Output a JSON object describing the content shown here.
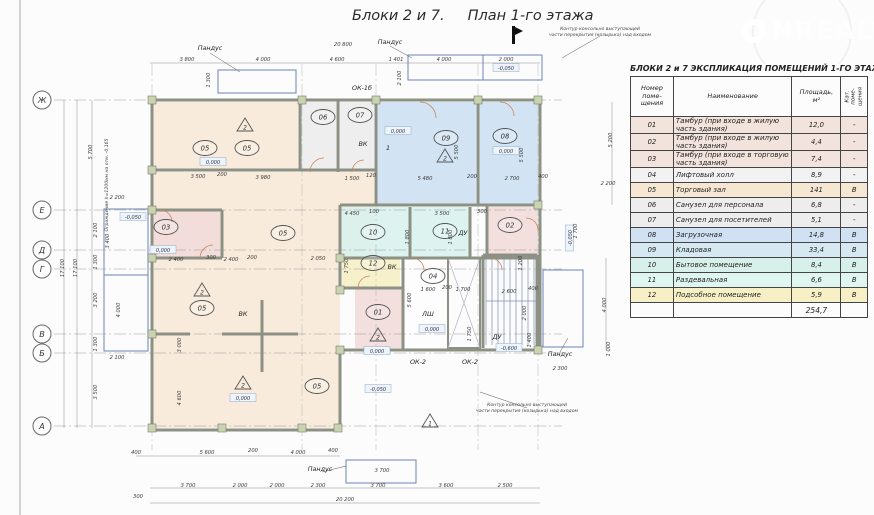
{
  "title": "Блоки 2 и 7.     План 1-го этажа",
  "watermark": {
    "full": "ONREALT",
    "text": "NREALT"
  },
  "table": {
    "title": "БЛОКИ  2 и 7   ЭКСПЛИКАЦИЯ ПОМЕЩЕНИЙ 1-ГО ЭТАЖА",
    "headers": {
      "num": "Номер\nпоме-\nщения",
      "name": "Наименование",
      "area": "Площадь,\nм²",
      "cat": "Кат. поме-\nщения"
    },
    "rows": [
      {
        "num": "01",
        "name": "Тамбур (при входе в жилую часть здания)",
        "area": "12,0",
        "cat": "-",
        "color": "#f2e3dd"
      },
      {
        "num": "02",
        "name": "Тамбур (при входе в жилую часть здания)",
        "area": "4,4",
        "cat": "-",
        "color": "#f2e3dd"
      },
      {
        "num": "03",
        "name": "Тамбур (при входе в торговую часть здания)",
        "area": "7,4",
        "cat": "-",
        "color": "#f2e3dd"
      },
      {
        "num": "04",
        "name": "Лифтовый холл",
        "area": "8,9",
        "cat": "-",
        "color": "#f2f2f2"
      },
      {
        "num": "05",
        "name": "Торговый зал",
        "area": "141",
        "cat": "В",
        "color": "#f6e7d3"
      },
      {
        "num": "06",
        "name": "Санузел  для персонала",
        "area": "6,8",
        "cat": "-",
        "color": "#ededed"
      },
      {
        "num": "07",
        "name": "Санузел  для посетителей",
        "area": "5,1",
        "cat": "-",
        "color": "#ededed"
      },
      {
        "num": "08",
        "name": "Загрузочная",
        "area": "14,8",
        "cat": "В",
        "color": "#cfe1f3"
      },
      {
        "num": "09",
        "name": "Кладовая",
        "area": "33,4",
        "cat": "В",
        "color": "#d6e9f2"
      },
      {
        "num": "10",
        "name": "Бытовое помещение",
        "area": "8,4",
        "cat": "В",
        "color": "#d7f1ea"
      },
      {
        "num": "11",
        "name": "Раздевальная",
        "area": "6,6",
        "cat": "В",
        "color": "#def5f0"
      },
      {
        "num": "12",
        "name": "Подсобное помещение",
        "area": "5,9",
        "cat": "В",
        "color": "#f7f0c6"
      }
    ],
    "total": "254,7"
  },
  "colors": {
    "tan": "#f7e9d8",
    "blue": "#cde0f2",
    "cyan": "#d9f2ed",
    "pink": "#f1dcda",
    "grey": "#ececec",
    "yellow": "#f6efc5",
    "white": "#fdfdfd",
    "wall": "#8d9184",
    "ramp": "#6b84b8",
    "dim": "#3a3a3a"
  },
  "plan": {
    "axes": [
      {
        "label": "Ж",
        "y": 100
      },
      {
        "label": "Е",
        "y": 210
      },
      {
        "label": "Д",
        "y": 250
      },
      {
        "label": "Г",
        "y": 269
      },
      {
        "label": "В",
        "y": 334
      },
      {
        "label": "Б",
        "y": 353
      },
      {
        "label": "А",
        "y": 426
      }
    ],
    "rooms": [
      {
        "id": "05a",
        "x": 152,
        "y": 102,
        "w": 146,
        "h": 68,
        "fill": "tan"
      },
      {
        "id": "06",
        "x": 300,
        "y": 102,
        "w": 36,
        "h": 70,
        "fill": "grey"
      },
      {
        "id": "07",
        "x": 338,
        "y": 102,
        "w": 36,
        "h": 70,
        "fill": "grey"
      },
      {
        "id": "09",
        "x": 376,
        "y": 102,
        "w": 100,
        "h": 102,
        "fill": "blue"
      },
      {
        "id": "08",
        "x": 478,
        "y": 102,
        "w": 60,
        "h": 102,
        "fill": "blue"
      },
      {
        "id": "05b",
        "x": 152,
        "y": 172,
        "w": 222,
        "h": 86,
        "fill": "tan"
      },
      {
        "id": "05c",
        "x": 152,
        "y": 258,
        "w": 188,
        "h": 170,
        "fill": "tan"
      },
      {
        "id": "03",
        "x": 152,
        "y": 210,
        "w": 68,
        "h": 48,
        "fill": "pink"
      },
      {
        "id": "10",
        "x": 342,
        "y": 207,
        "w": 68,
        "h": 51,
        "fill": "cyan"
      },
      {
        "id": "11",
        "x": 410,
        "y": 207,
        "w": 60,
        "h": 51,
        "fill": "cyan"
      },
      {
        "id": "02",
        "x": 487,
        "y": 207,
        "w": 51,
        "h": 51,
        "fill": "pink"
      },
      {
        "id": "12",
        "x": 342,
        "y": 258,
        "w": 58,
        "h": 30,
        "fill": "yellow"
      },
      {
        "id": "01",
        "x": 355,
        "y": 288,
        "w": 48,
        "h": 60,
        "fill": "pink"
      },
      {
        "id": "04",
        "x": 403,
        "y": 258,
        "w": 45,
        "h": 90,
        "fill": "white"
      }
    ],
    "tags": [
      {
        "t": "05",
        "x": 205,
        "y": 148
      },
      {
        "t": "05",
        "x": 247,
        "y": 148
      },
      {
        "t": "06",
        "x": 323,
        "y": 117
      },
      {
        "t": "07",
        "x": 360,
        "y": 115
      },
      {
        "t": "09",
        "x": 446,
        "y": 138
      },
      {
        "t": "08",
        "x": 505,
        "y": 136
      },
      {
        "t": "05",
        "x": 283,
        "y": 233
      },
      {
        "t": "03",
        "x": 166,
        "y": 227
      },
      {
        "t": "10",
        "x": 373,
        "y": 232
      },
      {
        "t": "11",
        "x": 445,
        "y": 231
      },
      {
        "t": "02",
        "x": 510,
        "y": 225
      },
      {
        "t": "12",
        "x": 373,
        "y": 263
      },
      {
        "t": "01",
        "x": 378,
        "y": 312
      },
      {
        "t": "04",
        "x": 433,
        "y": 276
      },
      {
        "t": "05",
        "x": 202,
        "y": 308
      },
      {
        "t": "05",
        "x": 317,
        "y": 386
      }
    ],
    "triangles": [
      {
        "t": "2",
        "x": 245,
        "y": 126
      },
      {
        "t": "2",
        "x": 445,
        "y": 157
      },
      {
        "t": "2",
        "x": 202,
        "y": 291
      },
      {
        "t": "2",
        "x": 243,
        "y": 384
      },
      {
        "t": "2",
        "x": 378,
        "y": 336
      },
      {
        "t": "1",
        "x": 430,
        "y": 422
      }
    ],
    "levels": [
      {
        "t": "0,000",
        "x": 213,
        "y": 163
      },
      {
        "t": "0,000",
        "x": 398,
        "y": 132
      },
      {
        "t": "0,000",
        "x": 506,
        "y": 152
      },
      {
        "t": "0,000",
        "x": 163,
        "y": 251
      },
      {
        "t": "0,000",
        "x": 243,
        "y": 399
      },
      {
        "t": "0,000",
        "x": 377,
        "y": 352
      },
      {
        "t": "0,000",
        "x": 432,
        "y": 330
      },
      {
        "t": "-0,050",
        "x": 133,
        "y": 218
      },
      {
        "t": "-0,050",
        "x": 506,
        "y": 69
      },
      {
        "t": "-0,050",
        "x": 571,
        "y": 238,
        "r": -90
      },
      {
        "t": "-0,050",
        "x": 378,
        "y": 390
      },
      {
        "t": "-0,600",
        "x": 509,
        "y": 349
      }
    ],
    "labels": [
      {
        "t": "Пандус",
        "x": 210,
        "y": 50
      },
      {
        "t": "Пандус",
        "x": 390,
        "y": 44
      },
      {
        "t": "Пандус",
        "x": 560,
        "y": 356
      },
      {
        "t": "Пандус",
        "x": 320,
        "y": 471
      },
      {
        "t": "ВК",
        "x": 363,
        "y": 146
      },
      {
        "t": "ВК",
        "x": 243,
        "y": 316
      },
      {
        "t": "ВК",
        "x": 392,
        "y": 269
      },
      {
        "t": "ЛШ",
        "x": 428,
        "y": 316
      },
      {
        "t": "ДУ",
        "x": 463,
        "y": 235
      },
      {
        "t": "ДУ",
        "x": 497,
        "y": 339
      },
      {
        "t": "1",
        "x": 388,
        "y": 150
      },
      {
        "t": "ОК-1б",
        "x": 362,
        "y": 90
      },
      {
        "t": "ОК-2",
        "x": 418,
        "y": 364
      },
      {
        "t": "ОК-2",
        "x": 470,
        "y": 364
      }
    ],
    "dims": [
      {
        "t": "20 800",
        "x": 343,
        "y": 46
      },
      {
        "t": "3 800",
        "x": 187,
        "y": 61
      },
      {
        "t": "4 000",
        "x": 263,
        "y": 61
      },
      {
        "t": "4 600",
        "x": 337,
        "y": 61
      },
      {
        "t": "1 401",
        "x": 396,
        "y": 61
      },
      {
        "t": "4 000",
        "x": 444,
        "y": 61
      },
      {
        "t": "2 000",
        "x": 506,
        "y": 61
      },
      {
        "t": "1 300",
        "x": 210,
        "y": 80,
        "r": -90
      },
      {
        "t": "2 100",
        "x": 401,
        "y": 78,
        "r": -90
      },
      {
        "t": "3 500",
        "x": 198,
        "y": 178
      },
      {
        "t": "200",
        "x": 222,
        "y": 176
      },
      {
        "t": "3 980",
        "x": 263,
        "y": 179
      },
      {
        "t": "1 500",
        "x": 352,
        "y": 180
      },
      {
        "t": "120",
        "x": 371,
        "y": 177
      },
      {
        "t": "5 480",
        "x": 425,
        "y": 180
      },
      {
        "t": "200",
        "x": 472,
        "y": 178
      },
      {
        "t": "2 700",
        "x": 512,
        "y": 180
      },
      {
        "t": "400",
        "x": 543,
        "y": 178
      },
      {
        "t": "2 200",
        "x": 608,
        "y": 185
      },
      {
        "t": "4 450",
        "x": 352,
        "y": 215
      },
      {
        "t": "100",
        "x": 374,
        "y": 213
      },
      {
        "t": "3 500",
        "x": 442,
        "y": 215
      },
      {
        "t": "300",
        "x": 482,
        "y": 213
      },
      {
        "t": "2 400",
        "x": 176,
        "y": 261
      },
      {
        "t": "300",
        "x": 211,
        "y": 259
      },
      {
        "t": "2 400",
        "x": 231,
        "y": 261
      },
      {
        "t": "200",
        "x": 252,
        "y": 259
      },
      {
        "t": "2 050",
        "x": 318,
        "y": 260
      },
      {
        "t": "1 750",
        "x": 348,
        "y": 266,
        "r": -90
      },
      {
        "t": "5 600",
        "x": 411,
        "y": 300,
        "r": -90
      },
      {
        "t": "1 600",
        "x": 428,
        "y": 291
      },
      {
        "t": "200",
        "x": 447,
        "y": 289
      },
      {
        "t": "1 700",
        "x": 463,
        "y": 291
      },
      {
        "t": "2 600",
        "x": 509,
        "y": 293
      },
      {
        "t": "400",
        "x": 533,
        "y": 290
      },
      {
        "t": "1 200",
        "x": 522,
        "y": 263,
        "r": -90
      },
      {
        "t": "2 000",
        "x": 526,
        "y": 313,
        "r": -90
      },
      {
        "t": "1 400",
        "x": 531,
        "y": 340,
        "r": -90
      },
      {
        "t": "1 750",
        "x": 471,
        "y": 334,
        "r": -90
      },
      {
        "t": "5 500",
        "x": 458,
        "y": 152,
        "r": -90
      },
      {
        "t": "5 500",
        "x": 523,
        "y": 155,
        "r": -90
      },
      {
        "t": "5 200",
        "x": 612,
        "y": 140,
        "r": -90
      },
      {
        "t": "1 800",
        "x": 409,
        "y": 237,
        "r": -90
      },
      {
        "t": "1 800",
        "x": 452,
        "y": 237,
        "r": -90
      },
      {
        "t": "1 700",
        "x": 577,
        "y": 231,
        "r": -90
      },
      {
        "t": "4 000",
        "x": 606,
        "y": 305,
        "r": -90
      },
      {
        "t": "1 000",
        "x": 610,
        "y": 349,
        "r": -90
      },
      {
        "t": "2 300",
        "x": 560,
        "y": 370
      },
      {
        "t": "5 700",
        "x": 92,
        "y": 152,
        "r": -90
      },
      {
        "t": "2 200",
        "x": 117,
        "y": 199
      },
      {
        "t": "2 100",
        "x": 97,
        "y": 230,
        "r": -90
      },
      {
        "t": "3 400",
        "x": 109,
        "y": 241,
        "r": -90
      },
      {
        "t": "1 300",
        "x": 97,
        "y": 262,
        "r": -90
      },
      {
        "t": "3 200",
        "x": 97,
        "y": 300,
        "r": -90
      },
      {
        "t": "4 000",
        "x": 120,
        "y": 310,
        "r": -90
      },
      {
        "t": "1 300",
        "x": 97,
        "y": 344,
        "r": -90
      },
      {
        "t": "2 100",
        "x": 117,
        "y": 359
      },
      {
        "t": "3 500",
        "x": 97,
        "y": 392,
        "r": -90
      },
      {
        "t": "17 100",
        "x": 64,
        "y": 268,
        "r": -90
      },
      {
        "t": "17 100",
        "x": 77,
        "y": 268,
        "r": -90
      },
      {
        "t": "3 000",
        "x": 181,
        "y": 345,
        "r": -90
      },
      {
        "t": "4 600",
        "x": 181,
        "y": 398,
        "r": -90
      },
      {
        "t": "300",
        "x": 138,
        "y": 498
      },
      {
        "t": "400",
        "x": 136,
        "y": 454
      },
      {
        "t": "5 600",
        "x": 207,
        "y": 454
      },
      {
        "t": "200",
        "x": 253,
        "y": 452
      },
      {
        "t": "4 000",
        "x": 298,
        "y": 454
      },
      {
        "t": "400",
        "x": 333,
        "y": 452
      },
      {
        "t": "3 700",
        "x": 382,
        "y": 472
      },
      {
        "t": "3 700",
        "x": 188,
        "y": 487
      },
      {
        "t": "2 000",
        "x": 240,
        "y": 487
      },
      {
        "t": "2 000",
        "x": 277,
        "y": 487
      },
      {
        "t": "2 300",
        "x": 318,
        "y": 487
      },
      {
        "t": "3 700",
        "x": 378,
        "y": 487
      },
      {
        "t": "3 600",
        "x": 446,
        "y": 487
      },
      {
        "t": "2 500",
        "x": 505,
        "y": 487
      },
      {
        "t": "20 200",
        "x": 345,
        "y": 501
      }
    ],
    "notes": [
      {
        "x": 600,
        "y": 30,
        "lines": [
          "Контур консольно выступающей",
          "части перекрытия (козырька) над входом"
        ]
      },
      {
        "x": 527,
        "y": 406,
        "lines": [
          "Контур консольно выступающей",
          "части перекрытия (козырька) над входом"
        ]
      },
      {
        "x": 108,
        "y": 185,
        "r": -90,
        "lines": [
          "Ограждение h=1200мм на отм. -0,165"
        ]
      }
    ]
  }
}
